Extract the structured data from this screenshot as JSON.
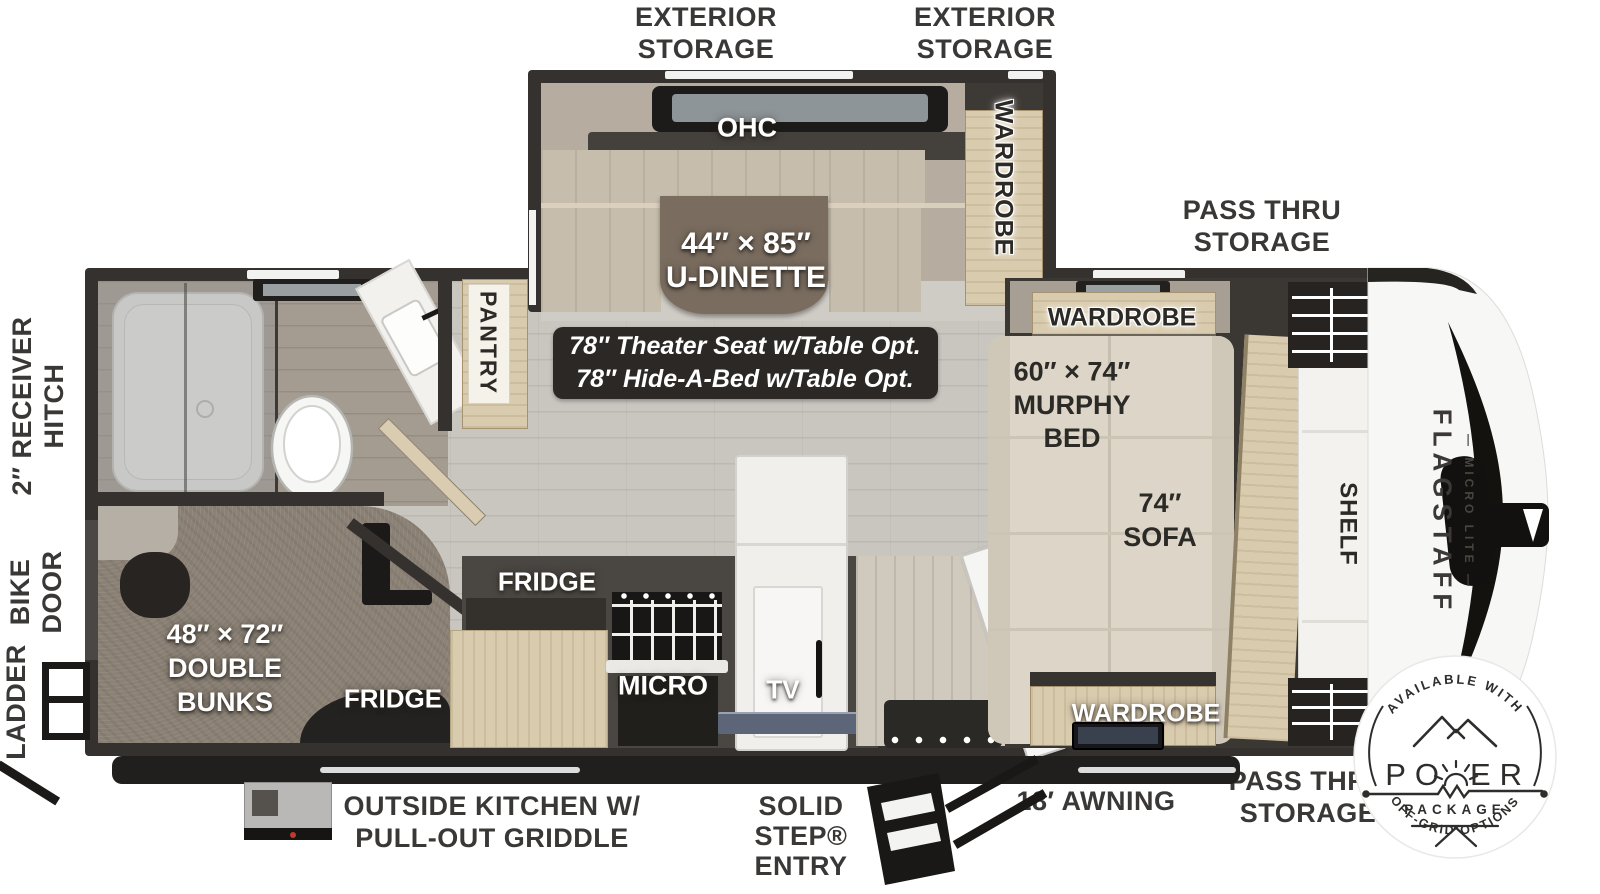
{
  "title": "Flagstaff Micro Lite travel trailer floor plan",
  "exterior": {
    "storage_top_left": "EXTERIOR\nSTORAGE",
    "storage_top_right": "EXTERIOR\nSTORAGE",
    "pass_thru_top": "PASS THRU\nSTORAGE",
    "receiver_hitch": "2″ RECEIVER\nHITCH",
    "bike_door": "BIKE\nDOOR",
    "ladder": "LADDER",
    "outside_kitchen": "OUTSIDE KITCHEN W/\nPULL-OUT GRIDDLE",
    "solid_step": "SOLID\nSTEP®\nENTRY",
    "awning": "18′ AWNING",
    "pass_thru_bottom": "PASS THRU\nSTORAGE"
  },
  "interior": {
    "ohc": "OHC",
    "dinette_size": "44″ × 85″",
    "dinette_name": "U-DINETTE",
    "wardrobe_slide": "WARDROBE",
    "theater_option_1": "78″ Theater Seat w/Table Opt.",
    "theater_option_2": "78″ Hide-A-Bed w/Table Opt.",
    "pantry": "PANTRY",
    "wardrobe_front_top": "WARDROBE",
    "murphy_size": "60″ × 74″",
    "murphy_name": "MURPHY\nBED",
    "sofa_label": "74″\nSOFA",
    "shelf": "SHELF",
    "fridge": "FRIDGE",
    "fridge_bunk": "FRIDGE",
    "micro": "MICRO",
    "tv": "TV",
    "wardrobe_front_bottom": "WARDROBE",
    "bunks": "48″ × 72″\nDOUBLE\nBUNKS"
  },
  "branding": {
    "model": "FLAGSTAFF",
    "series": "— MICRO LITE —",
    "badge_top": "AVAILABLE WITH",
    "badge_word_left": "PO",
    "badge_word_right": "ER",
    "badge_package": "PACKAGE",
    "badge_bottom": "OFF-GRID OPTIONS"
  },
  "colors": {
    "wall": "#34312e",
    "floor": "#c9c6c0",
    "carpet": "#8b8175",
    "cabinet": "#d9cbae",
    "sofa": "#ddd6c8",
    "table": "#7a6d60",
    "label_ink": "#3a3836",
    "badge_ink": "#2e2d2b"
  }
}
